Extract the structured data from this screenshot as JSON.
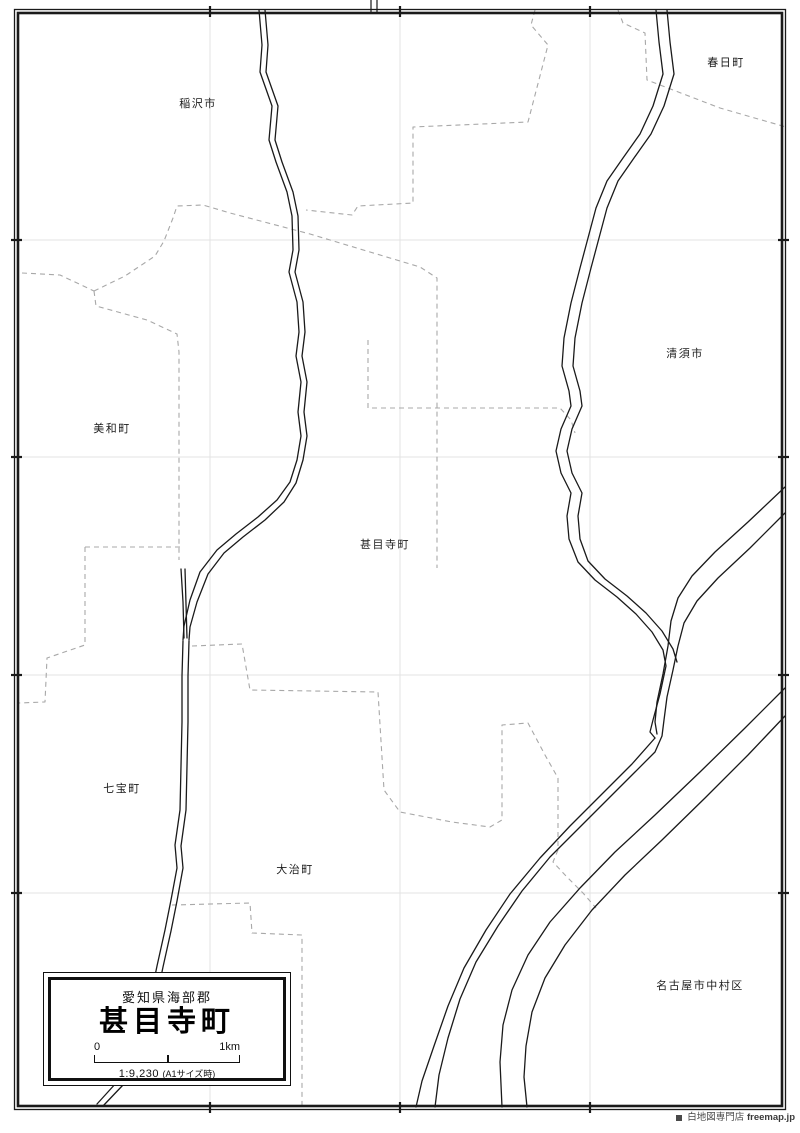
{
  "map": {
    "colors": {
      "river_line": "#1a1a1a",
      "boundary_dash": "#a8a8a8",
      "grid_line": "#e3e3e3",
      "frame": "#1a1a1a"
    },
    "places": [
      {
        "label": "稲沢市"
      },
      {
        "label": "春日町"
      },
      {
        "label": "清須市"
      },
      {
        "label": "美和町"
      },
      {
        "label": "甚目寺町"
      },
      {
        "label": "七宝町"
      },
      {
        "label": "大治町"
      },
      {
        "label": "名古屋市中村区"
      }
    ],
    "title_card": {
      "district": "愛知県海部郡",
      "name": "甚目寺町",
      "scale_zero": "0",
      "scale_max": "1km",
      "ratio": "1:9,230",
      "ratio_note": "(A1サイズ時)"
    },
    "credit": {
      "shop": "白地図専門店",
      "site": "freemap.jp"
    }
  }
}
